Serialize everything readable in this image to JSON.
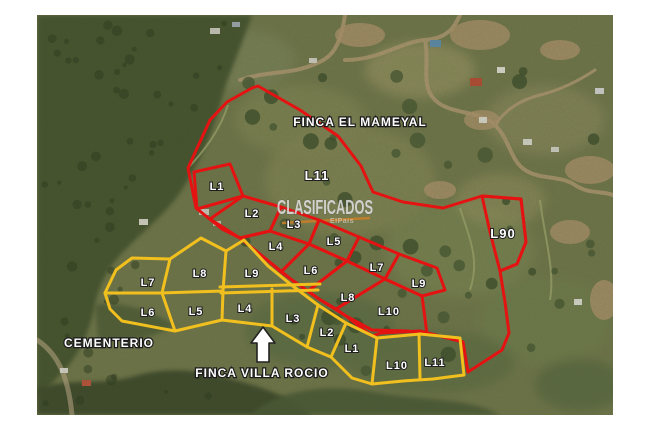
{
  "colors": {
    "red": "#e51212",
    "yellow": "#f2c01e",
    "road_orange": "#c87f28",
    "label_fill": "#ffffff",
    "label_stroke": "#1f1f1f"
  },
  "fincas": [
    {
      "id": "finca-el-mameyal",
      "color": "#e51212",
      "label": {
        "text": "FINCA EL MAMEYAL",
        "x": 360,
        "y": 126
      },
      "outer": [
        [
          258,
          86
        ],
        [
          300,
          110
        ],
        [
          338,
          136
        ],
        [
          361,
          166
        ],
        [
          373,
          192
        ],
        [
          403,
          202
        ],
        [
          443,
          208
        ],
        [
          482,
          196
        ],
        [
          521,
          199
        ],
        [
          526,
          242
        ],
        [
          517,
          264
        ],
        [
          500,
          271
        ],
        [
          505,
          302
        ],
        [
          509,
          333
        ],
        [
          502,
          350
        ],
        [
          468,
          372
        ],
        [
          463,
          342
        ],
        [
          420,
          331
        ],
        [
          381,
          333
        ],
        [
          372,
          336
        ],
        [
          346,
          316
        ],
        [
          319,
          299
        ],
        [
          292,
          280
        ],
        [
          266,
          259
        ],
        [
          240,
          238
        ],
        [
          222,
          229
        ],
        [
          196,
          208
        ],
        [
          188,
          168
        ],
        [
          210,
          120
        ],
        [
          227,
          102
        ],
        [
          252,
          88
        ]
      ],
      "lots": [
        {
          "label": "L1",
          "x": 217,
          "y": 190,
          "points": [
            [
              194,
              172
            ],
            [
              230,
              164
            ],
            [
              243,
              196
            ],
            [
              197,
              209
            ]
          ]
        },
        {
          "label": "L2",
          "x": 252,
          "y": 217,
          "points": [
            [
              243,
              196
            ],
            [
              281,
              207
            ],
            [
              270,
              231
            ],
            [
              240,
              238
            ],
            [
              210,
              219
            ]
          ]
        },
        {
          "label": "L3",
          "x": 294,
          "y": 228,
          "points": [
            [
              281,
              207
            ],
            [
              319,
              220
            ],
            [
              309,
              244
            ],
            [
              270,
              231
            ]
          ]
        },
        {
          "label": "L4",
          "x": 276,
          "y": 250,
          "points": [
            [
              270,
              231
            ],
            [
              309,
              244
            ],
            [
              281,
              272
            ],
            [
              266,
              259
            ],
            [
              240,
              238
            ]
          ]
        },
        {
          "label": "L5",
          "x": 334,
          "y": 245,
          "points": [
            [
              319,
              220
            ],
            [
              359,
              237
            ],
            [
              347,
              261
            ],
            [
              309,
              244
            ]
          ]
        },
        {
          "label": "L6",
          "x": 311,
          "y": 274,
          "points": [
            [
              309,
              244
            ],
            [
              347,
              261
            ],
            [
              308,
              291
            ],
            [
              292,
              280
            ],
            [
              281,
              272
            ]
          ]
        },
        {
          "label": "L7",
          "x": 377,
          "y": 271,
          "points": [
            [
              359,
              237
            ],
            [
              399,
              254
            ],
            [
              385,
              279
            ],
            [
              347,
              261
            ]
          ]
        },
        {
          "label": "L8",
          "x": 348,
          "y": 301,
          "points": [
            [
              347,
              261
            ],
            [
              385,
              279
            ],
            [
              336,
              309
            ],
            [
              319,
              299
            ],
            [
              308,
              291
            ]
          ]
        },
        {
          "label": "L9",
          "x": 419,
          "y": 287,
          "points": [
            [
              399,
              254
            ],
            [
              437,
              268
            ],
            [
              445,
              290
            ],
            [
              422,
              296
            ],
            [
              385,
              279
            ]
          ]
        },
        {
          "label": "L10",
          "x": 389,
          "y": 315,
          "points": [
            [
              385,
              279
            ],
            [
              422,
              296
            ],
            [
              427,
              334
            ],
            [
              408,
              331
            ],
            [
              372,
              330
            ],
            [
              346,
              316
            ],
            [
              336,
              309
            ]
          ]
        },
        {
          "label": "L11",
          "x": 317,
          "y": 180,
          "big": true,
          "points": null
        },
        {
          "label": "L90",
          "x": 503,
          "y": 238,
          "big": true,
          "points": [
            [
              482,
              196
            ],
            [
              521,
              199
            ],
            [
              526,
              242
            ],
            [
              517,
              264
            ],
            [
              500,
              271
            ],
            [
              490,
              232
            ]
          ]
        }
      ],
      "lines": []
    },
    {
      "id": "finca-villa-rocio",
      "color": "#f2c01e",
      "label": {
        "text": "FINCA  VILLA ROCIO",
        "x": 262,
        "y": 377
      },
      "outer": [
        [
          132,
          258
        ],
        [
          170,
          259
        ],
        [
          201,
          238
        ],
        [
          226,
          251
        ],
        [
          244,
          240
        ],
        [
          268,
          266
        ],
        [
          294,
          287
        ],
        [
          318,
          305
        ],
        [
          346,
          323
        ],
        [
          377,
          338
        ],
        [
          420,
          334
        ],
        [
          460,
          338
        ],
        [
          464,
          375
        ],
        [
          433,
          379
        ],
        [
          403,
          381
        ],
        [
          372,
          384
        ],
        [
          352,
          378
        ],
        [
          331,
          357
        ],
        [
          307,
          347
        ],
        [
          272,
          326
        ],
        [
          222,
          320
        ],
        [
          175,
          331
        ],
        [
          122,
          321
        ],
        [
          110,
          309
        ],
        [
          105,
          293
        ],
        [
          116,
          270
        ]
      ],
      "lots": [
        {
          "label": "L7",
          "x": 148,
          "y": 286,
          "points": null
        },
        {
          "label": "L8",
          "x": 200,
          "y": 277,
          "points": null
        },
        {
          "label": "L9",
          "x": 252,
          "y": 277,
          "points": null
        },
        {
          "label": "L6",
          "x": 148,
          "y": 316,
          "points": null
        },
        {
          "label": "L5",
          "x": 196,
          "y": 315,
          "points": null
        },
        {
          "label": "L4",
          "x": 245,
          "y": 312,
          "points": null
        },
        {
          "label": "L3",
          "x": 293,
          "y": 322,
          "points": null
        },
        {
          "label": "L2",
          "x": 327,
          "y": 336,
          "points": null
        },
        {
          "label": "L1",
          "x": 352,
          "y": 352,
          "points": null
        },
        {
          "label": "L10",
          "x": 397,
          "y": 369,
          "points": null
        },
        {
          "label": "L11",
          "x": 435,
          "y": 366,
          "points": null
        }
      ],
      "lines": [
        [
          [
            105,
            293
          ],
          [
            162,
            293
          ],
          [
            223,
            291
          ]
        ],
        [
          [
            220,
            287
          ],
          [
            320,
            284
          ]
        ],
        [
          [
            221,
            293
          ],
          [
            318,
            290
          ]
        ],
        [
          [
            170,
            259
          ],
          [
            162,
            293
          ]
        ],
        [
          [
            226,
            251
          ],
          [
            223,
            291
          ]
        ],
        [
          [
            162,
            293
          ],
          [
            175,
            331
          ]
        ],
        [
          [
            223,
            291
          ],
          [
            222,
            320
          ]
        ],
        [
          [
            272,
            289
          ],
          [
            272,
            326
          ]
        ],
        [
          [
            318,
            305
          ],
          [
            307,
            347
          ]
        ],
        [
          [
            346,
            323
          ],
          [
            331,
            357
          ]
        ],
        [
          [
            377,
            338
          ],
          [
            372,
            384
          ]
        ],
        [
          [
            419,
            334
          ],
          [
            420,
            378
          ]
        ]
      ]
    }
  ],
  "annotations": {
    "cementerio": {
      "text": "CEMENTERIO",
      "x": 109,
      "y": 347
    },
    "arrow_points": [
      [
        263,
        327
      ],
      [
        275,
        343
      ],
      [
        269,
        343
      ],
      [
        269,
        362
      ],
      [
        257,
        362
      ],
      [
        257,
        343
      ],
      [
        251,
        343
      ]
    ],
    "orange_road": [
      [
        282,
        223
      ],
      [
        370,
        218
      ]
    ],
    "watermark": {
      "text": "CLASIFICADOS",
      "x": 325,
      "y": 214,
      "subtext": "ElPais",
      "sx": 354,
      "sy": 223
    }
  }
}
